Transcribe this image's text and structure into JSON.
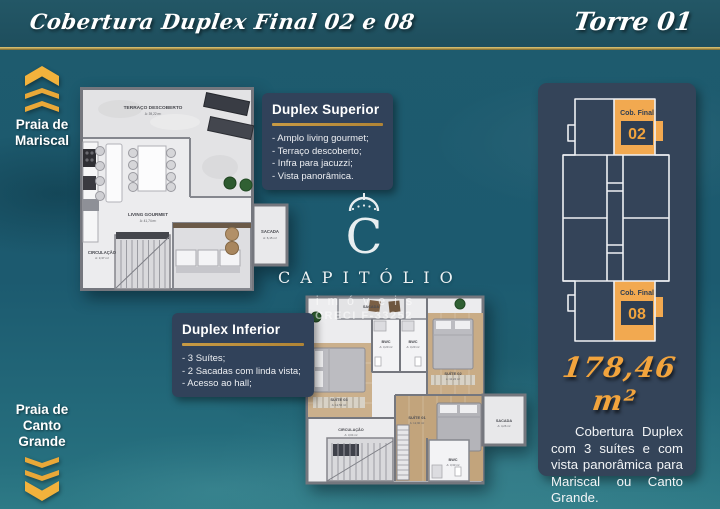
{
  "colors": {
    "gold": "#F2A950",
    "panel_navy": "#344459",
    "banner_teal": "#1F4E5D",
    "water_teal": "#1E5B6E"
  },
  "banner": {
    "title_left": "Cobertura Duplex Final 02 e 08",
    "title_right": "Torre 01"
  },
  "markers": {
    "mariscal": {
      "lines": [
        "Praia de",
        "Mariscal"
      ]
    },
    "canto_grande": {
      "lines": [
        "Praia de",
        "Canto",
        "Grande"
      ]
    }
  },
  "panels": {
    "superior": {
      "title": "Duplex Superior",
      "items": [
        "- Amplo living gourmet;",
        "- Terraço descoberto;",
        "- Infra para jacuzzi;",
        "- Vista panorâmica."
      ]
    },
    "inferior": {
      "title": "Duplex Inferior",
      "items": [
        "- 3 Suítes;",
        "- 2 Sacadas com linda vista;",
        "- Acesso ao hall;"
      ]
    }
  },
  "plan_superior": {
    "terraco_label": "TERRAÇO DESCOBERTO",
    "terraco_area": "A: 39,22 m²",
    "living_label": "LIVING GOURMET",
    "living_area": "A: 41,74 m²",
    "circulacao_label": "CIRCULAÇÃO",
    "circulacao_area": "A: 3,37 m²",
    "sacada_label": "SACADA",
    "sacada_area": "A: 6,15 m²"
  },
  "plan_inferior": {
    "sacada_top_label": "SACADA",
    "bwc1_label": "BWC",
    "bwc1_area": "A: 3,20 m²",
    "bwc2_label": "BWC",
    "bwc2_area": "A: 3,20 m²",
    "suite02_label": "SUÍTE 02",
    "suite02_area": "A: 11,24 m²",
    "suite03_label": "SUÍTE 03",
    "suite03_area": "A: 12,52 m²",
    "suite01_label": "SUÍTE 01",
    "suite01_area": "A: 12,90 m²",
    "circulacao_label": "CIRCULAÇÃO",
    "circulacao_area": "A: 3,04 m²",
    "bwc3_label": "BWC",
    "bwc3_area": "A: 3,33 m²",
    "sacada_right_label": "SACADA",
    "sacada_right_area": "A: 4,26 m²"
  },
  "watermark": {
    "brand": "CAPITÓLIO",
    "sub": "imóveis",
    "creci": "CRECI F-33252"
  },
  "tower_key": {
    "top_label": "Cob. Final",
    "top_number": "02",
    "bottom_label": "Cob. Final",
    "bottom_number": "08"
  },
  "summary": {
    "area": "178,46 m²",
    "description": "Cobertura Duplex com 3 suítes e com vista panorâmica para Mariscal ou Canto Grande."
  }
}
